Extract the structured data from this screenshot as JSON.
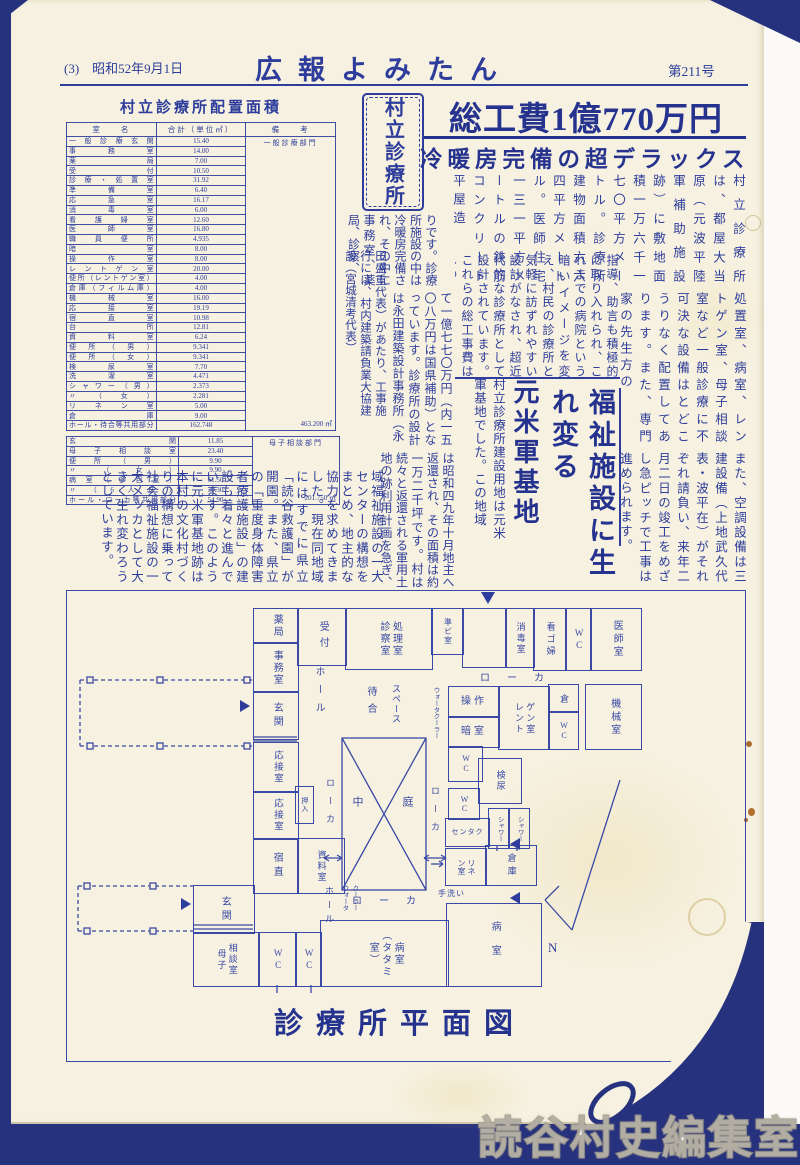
{
  "page": {
    "page_label_date": "(3)　昭和52年9月1日",
    "publication": "広報よみたん",
    "issue": "第211号"
  },
  "colors": {
    "ink_blue": "#2e3d9b",
    "headline_blue": "#25338f",
    "frame_navy": "#27327f",
    "paper": "#f6f1e0"
  },
  "area_table": {
    "title": "村立診療所配置面積",
    "headers": [
      "室　　名",
      "合計（単位㎡）",
      "備　　考"
    ],
    "sections": [
      {
        "note_top": "一般診療部門",
        "note_bottom": "463.200 ㎡",
        "rows": [
          [
            "一般診療玄関",
            "15.40"
          ],
          [
            "事務室",
            "14.00"
          ],
          [
            "薬局",
            "7.00"
          ],
          [
            "受付",
            "10.50"
          ],
          [
            "診療・処置室",
            "31.92"
          ],
          [
            "準備室",
            "6.40"
          ],
          [
            "応急室",
            "16.17"
          ],
          [
            "消毒室",
            "6.00"
          ],
          [
            "看護婦室",
            "12.60"
          ],
          [
            "医師室",
            "16.80"
          ],
          [
            "職員便所",
            "4.935"
          ],
          [
            "暗室",
            "8.00"
          ],
          [
            "操作室",
            "8.00"
          ],
          [
            "レントゲン室",
            "20.00"
          ],
          [
            "便所（レントゲン室）",
            "4.00"
          ],
          [
            "倉庫（フィルム庫）",
            "4.00"
          ],
          [
            "機械室",
            "16.00"
          ],
          [
            "応接室",
            "19.19"
          ],
          [
            "宿直室",
            "10.98"
          ],
          [
            "台所",
            "12.81"
          ],
          [
            "資料室",
            "6.24"
          ],
          [
            "便所（男）",
            "9.341"
          ],
          [
            "便所（女）",
            "9.341"
          ],
          [
            "検尿室",
            "7.70"
          ],
          [
            "洗濯室",
            "4.471"
          ],
          [
            "シャワー（男）",
            "2.373"
          ],
          [
            "〃（女）",
            "2.281"
          ],
          [
            "リネン室",
            "5.00"
          ],
          [
            "倉庫",
            "9.00"
          ],
          [
            "ホール・待合等共用部分",
            "162.748"
          ]
        ]
      },
      {
        "note_top": "母子相談部門",
        "note_bottom": "201.750 ㎡",
        "rows": [
          [
            "玄関",
            "11.85"
          ],
          [
            "母子相談室",
            "23.40"
          ],
          [
            "便所（男）",
            "9.90"
          ],
          [
            "〃（女）",
            "9.90"
          ],
          [
            "病室（多目室）",
            "61.50"
          ],
          [
            "〃（6人床）",
            "30.30"
          ],
          [
            "ホール・ローカ等共用部分",
            "54.90"
          ]
        ]
      }
    ]
  },
  "badge": "村立診療所",
  "headlines": {
    "main": "総工費1億770万円",
    "sub": "冷暖房完備の超デラックス"
  },
  "article": {
    "seg1": "村立診療所は、都屋大当原（元波平陸軍補助施設跡）に敷地面積一万六千一七〇平方メートル。診療所建物面積六六四平方メートル。医師住宅一三一平方メートルの鉄筋コンクリート平屋造",
    "seg1b": "りです。診療所施設の中は冷暖房完備され、その中に事務室、薬局、診察、",
    "seg2": "処置室、病室、レントゲン室、母子相談室など一般診療に不可決な設備はとどこうりなく配置してあります。また、専門家の先生方の",
    "seg3": "指導、助言も積極的に取り入れられ、これまでの病院という暗いイメージを変え、村民の診療所として誰でも",
    "seg4": "気軽に訪ずれやすい設計がなされ、超近代的な診療所として設計されています。これらの総工事費はしめ",
    "seg5": "て一億七七〇万円（内一五〇八万円は国県補助）となっています。診療所の設計は永田建築設計事務所（永",
    "seg6": "田盛重代表）があたり、工事施行には、村内建築請負業大協建設（宮城清考代表）",
    "seg7": "また、空調設備は三建設備（上地武久代表・波平在）がそれぞれ請負い、来年二月二日の竣工をめざし急ピッチで工事は進められます。",
    "subhead1": "福祉施設に生れ変る",
    "subhead2": "元米軍基地",
    "seg8": "村立診療所建設用地は元米軍基地でした。この地域",
    "seg9": "は昭和四九年十月地主へ返還され、その面積は約一万二千坪です。村は続々と返還される軍用土地の跡利用計画を急ぎ、とりわけ同地",
    "seg10": "域福祉施設の一大センターの構想をまとめ、地主的な協力を求めてきました。現在同地域にはすでに県立「読谷救護園」が開園。また、県立の「重度身体障害者療護施設」の建設も着々と進んでいます。このように元米軍基地跡は本村の文化村づくりの構想に乗って社会福祉施設の一大メッカとして大きく生れ変わろうとしています。"
  },
  "floorplan": {
    "caption": "診療所平面図",
    "compass_label": "N",
    "rooms": [
      [
        "薬局",
        253,
        608,
        44,
        34,
        "v",
        10,
        2
      ],
      [
        "事務室",
        253,
        642,
        44,
        49,
        "v",
        10,
        2
      ],
      [
        "玄関",
        253,
        691,
        44,
        47,
        "v",
        10,
        4
      ],
      [
        "応接室",
        253,
        742,
        44,
        49,
        "v",
        9.5,
        2
      ],
      [
        "応接室",
        253,
        791,
        44,
        47,
        "v",
        9.5,
        2
      ],
      [
        "宿直",
        253,
        838,
        44,
        54,
        "v",
        10,
        4
      ],
      [
        "押入",
        295,
        786,
        17,
        36,
        "v",
        7,
        1
      ],
      [
        "受付",
        297,
        608,
        48,
        56,
        "v",
        10,
        6
      ],
      [
        "処理室\n診察室",
        345,
        608,
        86,
        60,
        "v",
        10,
        2
      ],
      [
        "準ビ室",
        431,
        608,
        31,
        45,
        "v",
        8,
        1
      ],
      [
        "",
        462,
        608,
        43,
        58,
        "v",
        8,
        0
      ],
      [
        "消毒室",
        505,
        608,
        28,
        58,
        "v",
        9,
        2
      ],
      [
        "看ゴ婦",
        533,
        608,
        32,
        61,
        "v",
        9,
        3
      ],
      [
        "WC",
        565,
        608,
        25,
        61,
        "vwc",
        9,
        2
      ],
      [
        "医師室",
        590,
        608,
        50,
        61,
        "v",
        10,
        3
      ],
      [
        "操作",
        448,
        686,
        50,
        30,
        "h",
        10,
        3
      ],
      [
        "暗室",
        448,
        716,
        50,
        30,
        "h",
        10,
        3
      ],
      [
        "ゲン室\nレント",
        498,
        686,
        50,
        62,
        "v",
        9,
        2
      ],
      [
        "倉",
        548,
        684,
        29,
        27,
        "v",
        9,
        0
      ],
      [
        "WC",
        548,
        711,
        29,
        37,
        "vwc",
        8,
        1
      ],
      [
        "機械室",
        585,
        684,
        55,
        64,
        "v",
        10,
        3
      ],
      [
        "WC",
        448,
        746,
        33,
        34,
        "vwc",
        8,
        1
      ],
      [
        "検尿",
        478,
        758,
        42,
        44,
        "v",
        9,
        2
      ],
      [
        "WC",
        448,
        788,
        30,
        30,
        "vwc",
        8,
        0
      ],
      [
        "センタク",
        445,
        818,
        43,
        27,
        "h",
        7,
        1
      ],
      [
        "シャワー",
        488,
        808,
        20,
        39,
        "v",
        6.5,
        0
      ],
      [
        "シャワー",
        508,
        808,
        20,
        39,
        "v",
        6.5,
        0
      ],
      [
        "リネ\nン室",
        445,
        848,
        40,
        36,
        "v",
        8,
        0
      ],
      [
        "倉庫",
        485,
        845,
        50,
        39,
        "v",
        9,
        4
      ],
      [
        "病室",
        446,
        903,
        94,
        82,
        "v",
        10,
        14
      ],
      [
        "病室\n（タタミ室）",
        320,
        920,
        127,
        65,
        "v",
        10,
        2
      ],
      [
        "相談室\n母子",
        193,
        932,
        65,
        53,
        "v",
        9,
        2
      ],
      [
        "WC",
        258,
        932,
        37,
        53,
        "vwc",
        9,
        2
      ],
      [
        "WC",
        295,
        932,
        25,
        53,
        "vwc",
        9,
        2
      ],
      [
        "玄関",
        193,
        885,
        60,
        47,
        "v",
        10,
        4
      ],
      [
        "資料室",
        297,
        838,
        46,
        54,
        "v",
        9,
        2
      ]
    ],
    "labels": [
      [
        "ホール",
        311,
        666,
        "v",
        10,
        8
      ],
      [
        "ホール",
        323,
        886,
        "v",
        9,
        5
      ],
      [
        "ローカ",
        480,
        669,
        "h",
        10,
        17
      ],
      [
        "ローカ",
        324,
        778,
        "v",
        9,
        9
      ],
      [
        "ローカ",
        429,
        786,
        "v",
        9,
        9
      ],
      [
        "ローカ",
        352,
        892,
        "h",
        10,
        17
      ],
      [
        "待合",
        363,
        686,
        "v",
        10,
        7
      ],
      [
        "スペース",
        390,
        684,
        "v",
        9,
        1
      ],
      [
        "中",
        349,
        796,
        "v",
        11,
        0
      ],
      [
        "庭",
        399,
        796,
        "v",
        11,
        0
      ],
      [
        "手洗い",
        438,
        888,
        "h",
        8,
        1
      ],
      [
        "ウォータクーラー",
        430,
        687,
        "v",
        6.5,
        0
      ],
      [
        "クーラー\nウォータ",
        339,
        885,
        "v",
        6.5,
        0
      ]
    ]
  },
  "watermark": "読谷村史編集室"
}
